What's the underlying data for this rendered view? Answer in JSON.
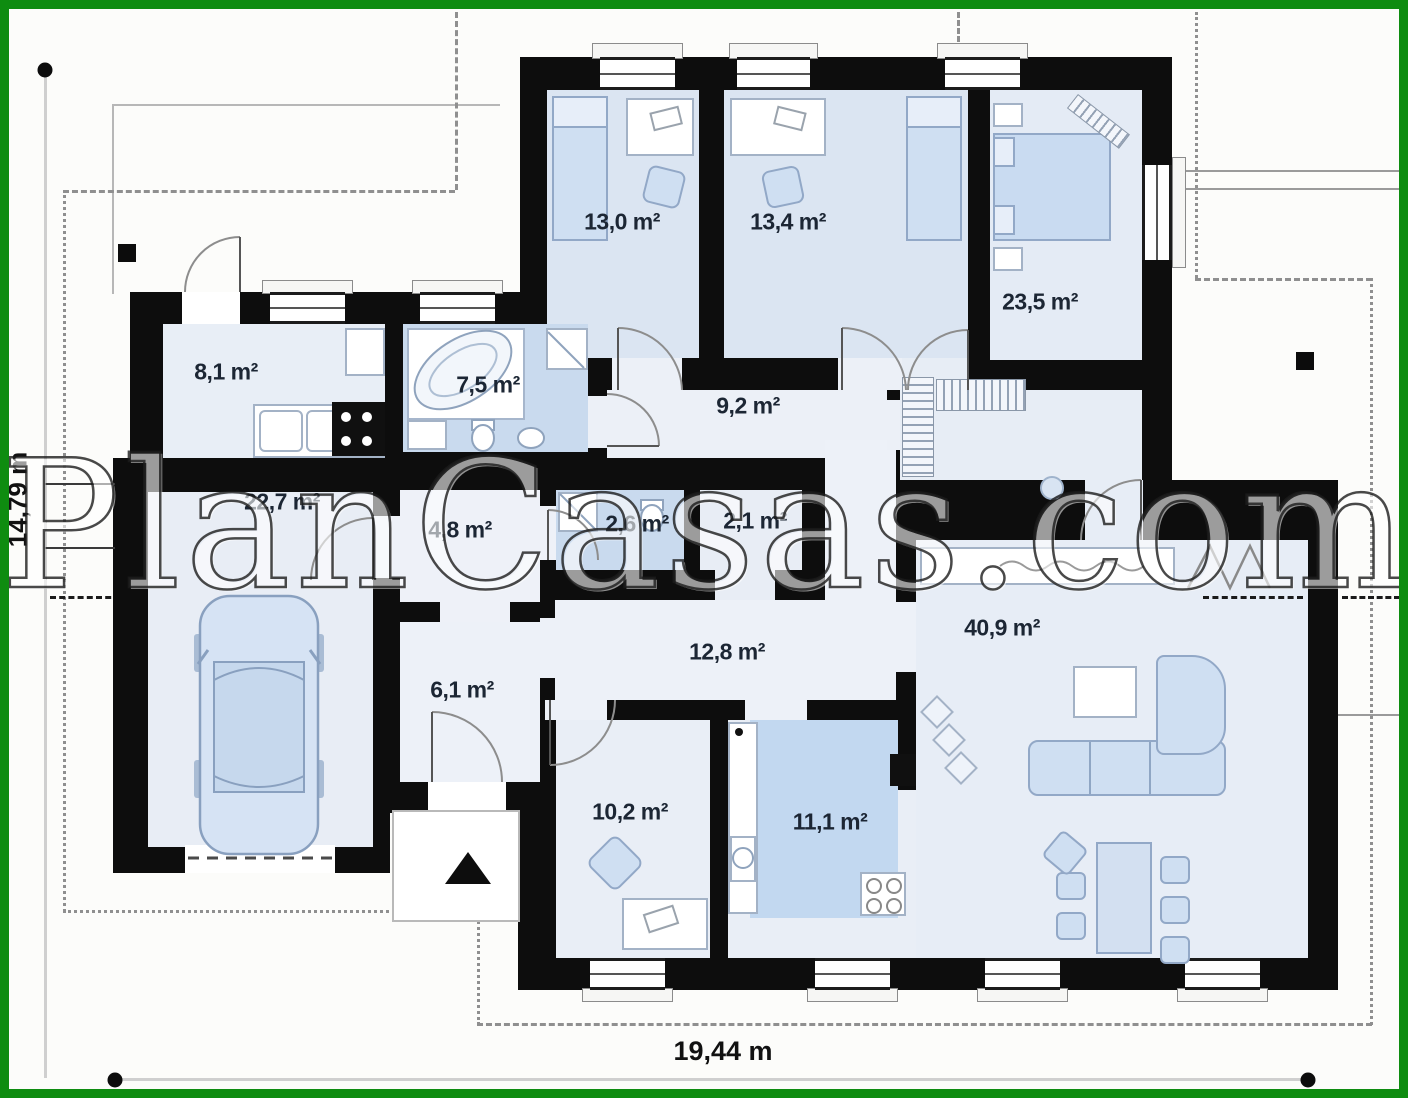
{
  "watermark": "PlanCasas.com",
  "dimensions": {
    "width_label": "19,44 m",
    "height_label": "14,79 m"
  },
  "rooms": [
    {
      "id": "bedroom-1",
      "area": "13,0 m²"
    },
    {
      "id": "bedroom-2",
      "area": "13,4 m²"
    },
    {
      "id": "master-bedroom",
      "area": "23,5 m²"
    },
    {
      "id": "utility-room",
      "area": "8,1 m²"
    },
    {
      "id": "bathroom",
      "area": "7,5 m²"
    },
    {
      "id": "hallway",
      "area": "9,2 m²"
    },
    {
      "id": "garage",
      "area": "22,7 m²"
    },
    {
      "id": "hall",
      "area": "4,8 m²"
    },
    {
      "id": "wc",
      "area": "2,6 m²"
    },
    {
      "id": "closet",
      "area": "2,1 m²"
    },
    {
      "id": "corridor",
      "area": "12,8 m²"
    },
    {
      "id": "entrance-hall",
      "area": "6,1 m²"
    },
    {
      "id": "living-room",
      "area": "40,9 m²"
    },
    {
      "id": "office",
      "area": "10,2 m²"
    },
    {
      "id": "kitchen",
      "area": "11,1 m²"
    }
  ],
  "icons": {
    "entrance_arrow": "triangle-up",
    "section_markers": "filled-square"
  },
  "colors": {
    "frame_green": "#0e8c10",
    "wall_black": "#0d0d0d",
    "room_fill": "#e9eef6",
    "wet_room_fill": "#c9daee",
    "kitchen_floor_fill": "#c2d8f0",
    "furniture_fill": "#cfdff2"
  }
}
